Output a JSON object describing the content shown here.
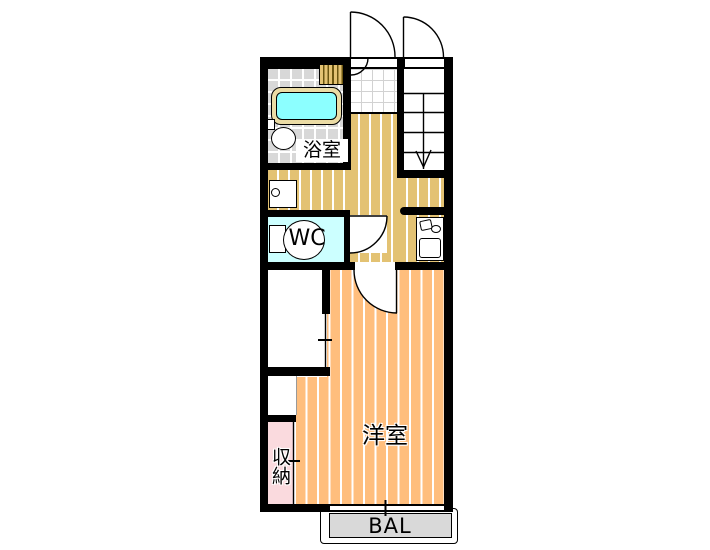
{
  "floorplan": {
    "labels": {
      "bathroom": "浴室",
      "wc": "WC",
      "western_room": "洋室",
      "storage": "収納",
      "balcony": "BAL"
    },
    "fixtures": [
      "bathtub",
      "washbasin",
      "toilet",
      "washing-machine-pan",
      "shoe-cabinet",
      "kitchen-unit",
      "staircase-down",
      "entrance-door",
      "stair-door",
      "wc-door",
      "room-door",
      "window",
      "balcony"
    ],
    "colors": {
      "wall": "#000000",
      "wood": "#e3c273",
      "room": "#ffbe7d",
      "storage": "#fadade",
      "wc": "#ccffff",
      "tubWater": "#8cffff",
      "tubRim": "#ebdca5",
      "tile": "#d8d8d8",
      "balconyGray": "#d9d9d9"
    }
  }
}
